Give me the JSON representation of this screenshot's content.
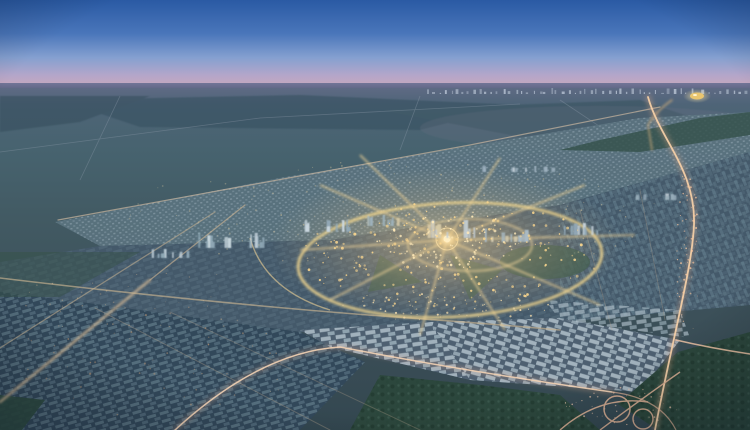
{
  "meta": {
    "alt": "Aerial dusk rendering of a master-planned desert city with a glowing central ring road, radial boulevards, grid suburbs, lit highways and a cloverleaf interchange",
    "width": 750,
    "height": 430
  },
  "palette": {
    "sky_top": "#2a5aa4",
    "sky_mid": "#4a76ba",
    "sky_light": "#8aa3d2",
    "dusk_pink": "#c7a8bd",
    "horizon_band": "#4d5b79",
    "plain": "#476271",
    "city_base": "#44596a",
    "suburb_light": "#b2c3cc",
    "road_gold": "#f4d88e",
    "road_warm": "#d2b794",
    "highway_pink": "#dfa98d",
    "forest_green": "#2c473d",
    "lights_amber": "#ffd98f",
    "dome_gold": "#e9c56f"
  },
  "scene": {
    "seed": 1337,
    "light_fields": [
      {
        "x": 450,
        "y": 255,
        "rx": 150,
        "ry": 55,
        "count": 220,
        "color": "#ffd98f",
        "s0": 0.5,
        "s1": 1.5,
        "op": 0.9
      },
      {
        "x": 447,
        "y": 240,
        "rx": 70,
        "ry": 30,
        "count": 90,
        "color": "#ffe9b8",
        "s0": 0.5,
        "s1": 1.4,
        "op": 0.95
      },
      {
        "x": 450,
        "y": 305,
        "rx": 120,
        "ry": 16,
        "count": 70,
        "color": "#ffe3ae",
        "s0": 0.4,
        "s1": 1.2,
        "op": 0.85
      },
      {
        "x": 400,
        "y": 215,
        "rx": 280,
        "ry": 55,
        "count": 150,
        "color": "#e8d3a4",
        "s0": 0.4,
        "s1": 1.0,
        "op": 0.5
      },
      {
        "x": 687,
        "y": 255,
        "rx": 13,
        "ry": 85,
        "count": 60,
        "color": "#ffc9a0",
        "s0": 0.4,
        "s1": 1.1,
        "op": 0.8
      },
      {
        "x": 160,
        "y": 360,
        "rx": 150,
        "ry": 58,
        "count": 60,
        "color": "#d9a87c",
        "s0": 0.4,
        "s1": 1.1,
        "op": 0.5
      },
      {
        "x": 620,
        "y": 405,
        "rx": 60,
        "ry": 20,
        "count": 40,
        "color": "#f2c9ae",
        "s0": 0.4,
        "s1": 1.0,
        "op": 0.75
      },
      {
        "x": 140,
        "y": 300,
        "rx": 130,
        "ry": 35,
        "count": 45,
        "color": "#e3c298",
        "s0": 0.3,
        "s1": 0.9,
        "op": 0.45
      }
    ],
    "tower_clusters": [
      {
        "x": 195,
        "y": 248,
        "w": 70,
        "count": 14,
        "hMin": 6,
        "hMax": 16,
        "colors": [
          "#8fa8b6",
          "#c6d4dc"
        ]
      },
      {
        "x": 150,
        "y": 258,
        "w": 40,
        "count": 8,
        "hMin": 4,
        "hMax": 10,
        "colors": [
          "#8fa8b6",
          "#b7c7d1"
        ]
      },
      {
        "x": 300,
        "y": 232,
        "w": 50,
        "count": 10,
        "hMin": 5,
        "hMax": 14,
        "colors": [
          "#93aab8",
          "#c9d6de"
        ]
      },
      {
        "x": 360,
        "y": 226,
        "w": 40,
        "count": 8,
        "hMin": 5,
        "hMax": 13,
        "colors": [
          "#9db1ba",
          "#d8cba8"
        ]
      },
      {
        "x": 425,
        "y": 238,
        "w": 60,
        "count": 12,
        "hMin": 6,
        "hMax": 18,
        "colors": [
          "#d8cba8",
          "#c3ccd2"
        ]
      },
      {
        "x": 480,
        "y": 242,
        "w": 45,
        "count": 9,
        "hMin": 5,
        "hMax": 14,
        "colors": [
          "#a9bac4",
          "#d5cdb2"
        ]
      },
      {
        "x": 555,
        "y": 235,
        "w": 50,
        "count": 10,
        "hMin": 4,
        "hMax": 12,
        "colors": [
          "#93aab8",
          "#c6d2da"
        ]
      },
      {
        "x": 470,
        "y": 172,
        "w": 85,
        "count": 10,
        "hMin": 3,
        "hMax": 7,
        "colors": [
          "#9fb2c0",
          "#c3cfd8"
        ]
      },
      {
        "x": 615,
        "y": 200,
        "w": 60,
        "count": 8,
        "hMin": 3,
        "hMax": 8,
        "colors": [
          "#96abb8",
          "#bfcbd4"
        ]
      }
    ],
    "skyline": {
      "x0": 425,
      "x1": 748,
      "y": 94,
      "count": 55,
      "color": "#c3cedd",
      "maxH": 5,
      "op": 0.75
    },
    "landmark_dome": {
      "x": 697,
      "y": 96,
      "rx": 7,
      "ry": 3.5,
      "color": "#e9c56f"
    }
  }
}
